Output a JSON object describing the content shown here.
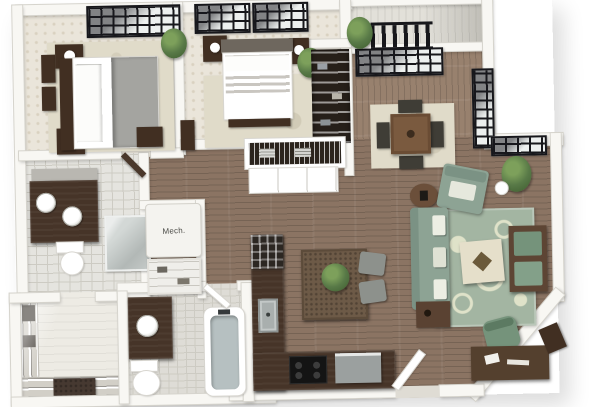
{
  "labels": {
    "mech_closet": "Mech."
  },
  "colors": {
    "white": "#ffffff",
    "wall": "#f8f7f3",
    "wall_edge": "#d6d4cd",
    "wood": "#8b7463",
    "wood_dining": "#98816e",
    "balcony": "#e2e0d9",
    "carpet": "#eae5da",
    "carpet_dot": "#d9d1c0",
    "tile": "#e5e4df",
    "tile2": "#dedcd6",
    "tile_line": "#cdcbc3",
    "glass": "#edf0ef",
    "frame": "#17171b",
    "dark_wood": "#412f22",
    "counter": "#463428",
    "island": "#6d5a47",
    "sofa_green": "#8da394",
    "chair_green": "#75937b",
    "rug_green": "#a3b5a2",
    "rug_swirl": "#dfe2c9",
    "rug_cream": "#e0dbc9",
    "cream": "#e5dfca",
    "gray_blanket": "#a4a4a0",
    "headboard": "#6e675e",
    "steel": "#a9afae",
    "tub": "#b6c0c1",
    "plant": "#587947",
    "plant_l": "#7da05b",
    "plant_d": "#3d5c2e",
    "stool": "#8d918c",
    "closet_dark": "#261f19",
    "label": "#4b4b47"
  }
}
